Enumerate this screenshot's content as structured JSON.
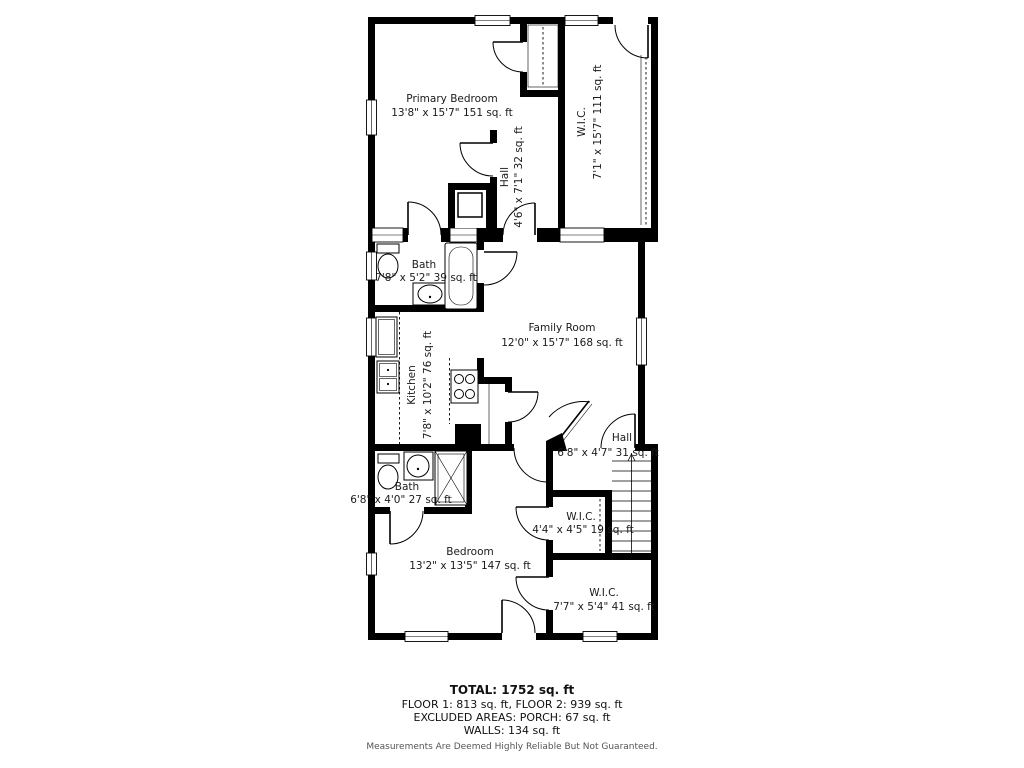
{
  "plan": {
    "rooms": [
      {
        "id": "primary-bedroom",
        "name": "Primary Bedroom",
        "dims": "13'8\" x 15'7\" 151 sq. ft"
      },
      {
        "id": "wic-upper",
        "name": "W.I.C.",
        "dims": "7'1\" x 15'7\" 111 sq. ft"
      },
      {
        "id": "hall-upper",
        "name": "Hall",
        "dims": "4'6\" x 7'1\" 32 sq. ft"
      },
      {
        "id": "bath-upper",
        "name": "Bath",
        "dims": "7'8\" x 5'2\" 39 sq. ft"
      },
      {
        "id": "family-room",
        "name": "Family Room",
        "dims": "12'0\" x 15'7\" 168 sq. ft"
      },
      {
        "id": "kitchen",
        "name": "Kitchen",
        "dims": "7'8\" x 10'2\" 76 sq. ft"
      },
      {
        "id": "hall-lower",
        "name": "Hall",
        "dims": "6'8\" x 4'7\" 31 sq. ft"
      },
      {
        "id": "bath-lower",
        "name": "Bath",
        "dims": "6'8\" x 4'0\" 27 sq. ft"
      },
      {
        "id": "wic-small",
        "name": "W.I.C.",
        "dims": "4'4\" x 4'5\" 19 sq. ft"
      },
      {
        "id": "bedroom",
        "name": "Bedroom",
        "dims": "13'2\" x 13'5\" 147 sq. ft"
      },
      {
        "id": "wic-lower",
        "name": "W.I.C.",
        "dims": "7'7\" x 5'4\" 41 sq. ft"
      }
    ],
    "summary": {
      "total": "TOTAL: 1752 sq. ft",
      "floors": "FLOOR 1: 813 sq. ft, FLOOR 2: 939 sq. ft",
      "excluded": "EXCLUDED AREAS: PORCH: 67 sq. ft",
      "walls": "WALLS: 134 sq. ft",
      "disclaimer": "Measurements Are Deemed Highly Reliable But Not Guaranteed."
    },
    "colors": {
      "wall": "#000000",
      "background": "#ffffff",
      "text": "#1a1a1a",
      "disclaimer": "#555555"
    }
  }
}
